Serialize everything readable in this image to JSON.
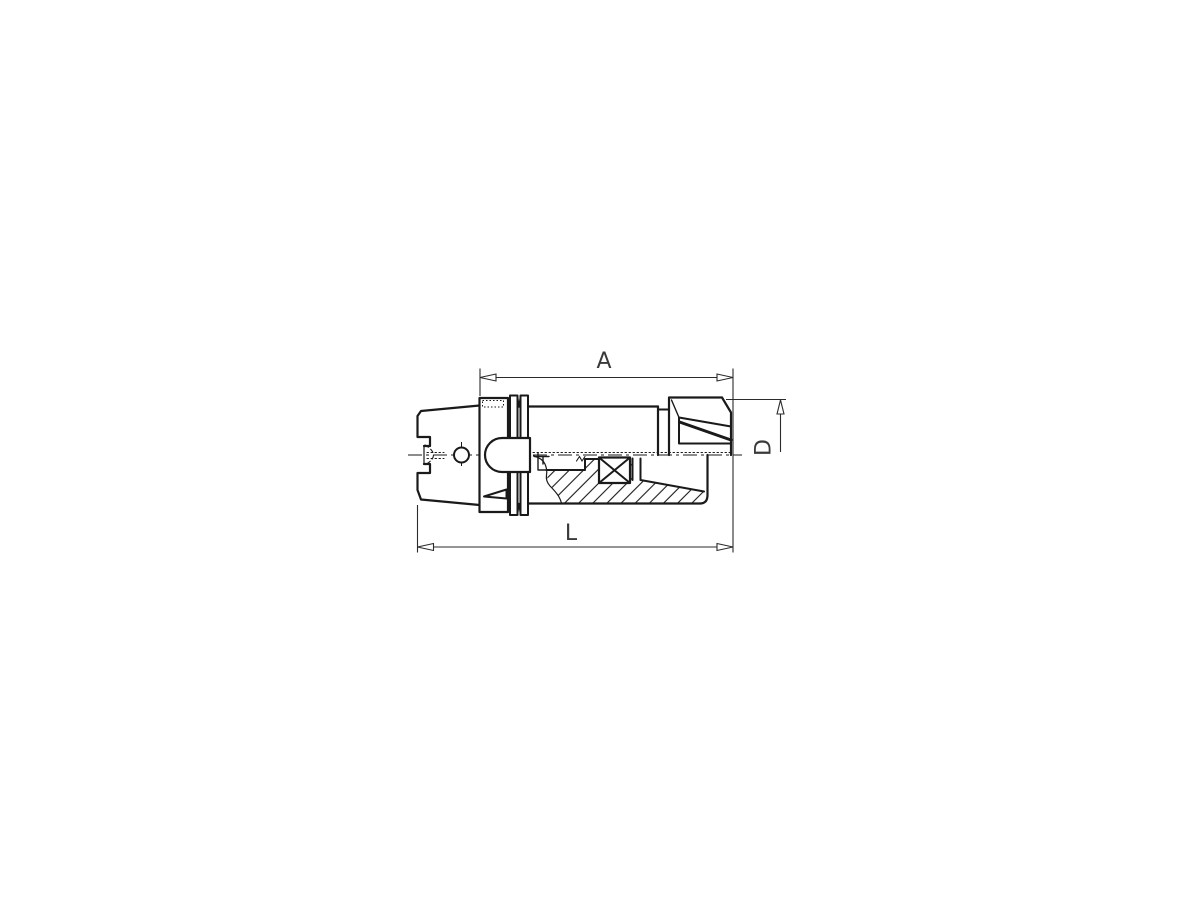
{
  "page": {
    "background_color": "#ffffff",
    "line_color": "#1a1a1a",
    "dim_line_color": "#2b2b2b"
  },
  "drawing": {
    "description": "Technical line drawing of an HSK shank collet chuck tool holder, side view with lower half section and hatching",
    "dimensions": {
      "a": {
        "label": "A"
      },
      "d": {
        "label": "D"
      },
      "l": {
        "label": "L"
      }
    }
  }
}
